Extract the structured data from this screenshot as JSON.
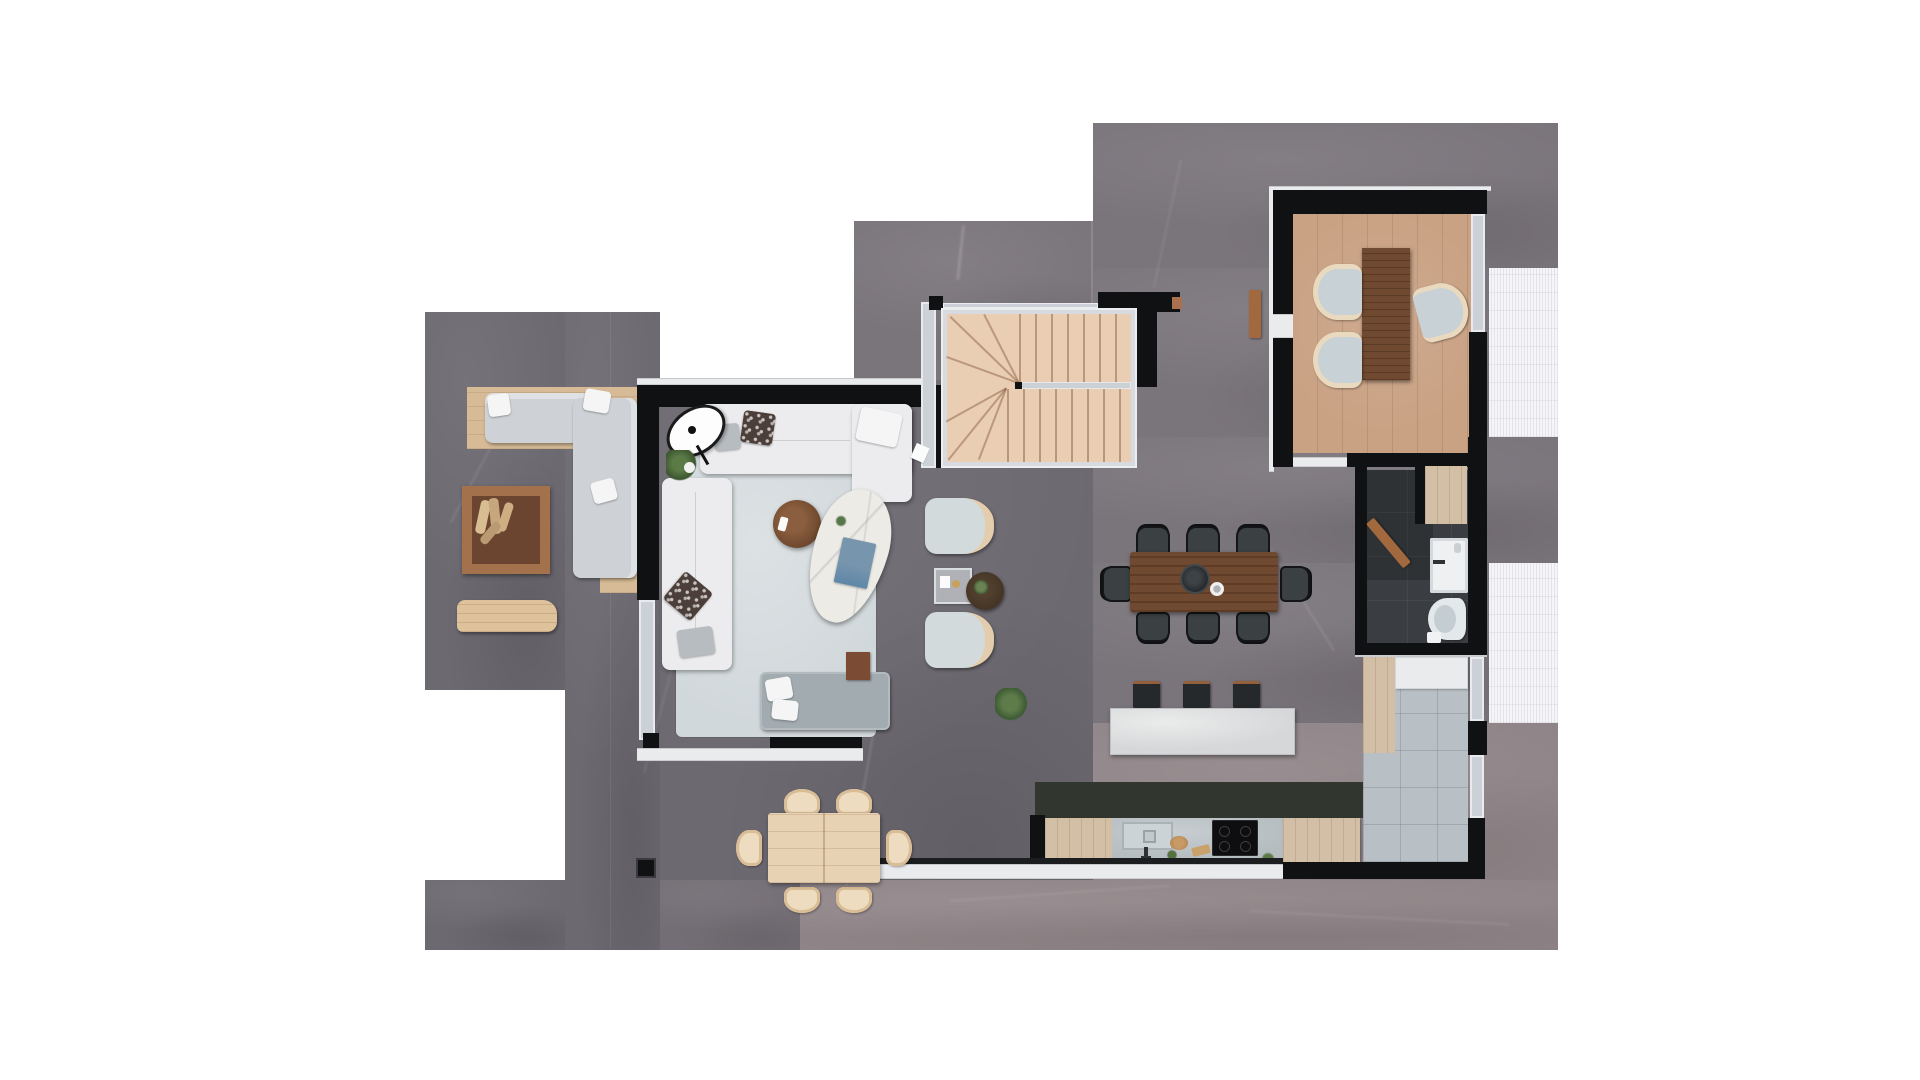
{
  "document": {
    "type": "architectural-floor-plan-render",
    "view": "top-down",
    "background": "#ffffff"
  },
  "palette": {
    "stone_a": "#6d6971",
    "stone_b": "#7a747b",
    "stone_c": "#8f8487",
    "stone_dark_band": "#31362f",
    "wall": "#101113",
    "glass": "#ccd1d7",
    "sill": "#e9ebed",
    "deck_white": "#f6f6f8",
    "wood_deck": "#d6bb96",
    "wood_cab": "#d2bfa6",
    "wood_floor": "#c9a183",
    "stairs_wood": "#e9ceb3",
    "walnut": "#6f4930",
    "rug": "#d1d8db",
    "sofa": "#ececee",
    "island": "#dbdcdd",
    "counter": "#b4bcc0",
    "tile_hall": "#b9c0c5",
    "tile_bath": "#3a3d41",
    "chair_dark": "#3b4042",
    "outdoor_wood": "#e7d2b4",
    "chair_cream": "#e9d9bf",
    "plant_green": "#4a6b3a",
    "daybed": "#a0a9ad",
    "door_wood": "#a2693f"
  },
  "regions": [
    {
      "id": "terrace-lounge",
      "kind": "outdoor-terrace"
    },
    {
      "id": "living-room",
      "kind": "glazed-living-pavilion"
    },
    {
      "id": "staircase",
      "kind": "u-shaped-stairs"
    },
    {
      "id": "study",
      "kind": "office-room"
    },
    {
      "id": "dining-area",
      "kind": "open-dining"
    },
    {
      "id": "kitchen",
      "kind": "kitchen-with-island"
    },
    {
      "id": "bathroom",
      "kind": "wc-shower"
    },
    {
      "id": "entry-hall",
      "kind": "tiled-hallway"
    },
    {
      "id": "terrace-dining",
      "kind": "outdoor-dining"
    },
    {
      "id": "deck-upper",
      "kind": "white-slat-deck"
    },
    {
      "id": "deck-lower",
      "kind": "white-slat-deck"
    }
  ],
  "furniture": [
    "outdoor-l-sofa",
    "firewood-box",
    "outdoor-bench",
    "sofa-top",
    "sofa-left",
    "floor-lamp",
    "coffee-table-marble",
    "coffee-table-wood",
    "armchair-1",
    "armchair-2",
    "glass-side-table",
    "round-side-table",
    "daybed",
    "side-cube",
    "rug",
    "plants",
    "desk-walnut",
    "office-chairs",
    "dining-table",
    "dining-chairs-8",
    "kitchen-island",
    "bar-stools-3",
    "sink",
    "cooktop",
    "cabinets",
    "wash-basin",
    "toilet",
    "wardrobes",
    "outdoor-table",
    "outdoor-chairs-6"
  ]
}
